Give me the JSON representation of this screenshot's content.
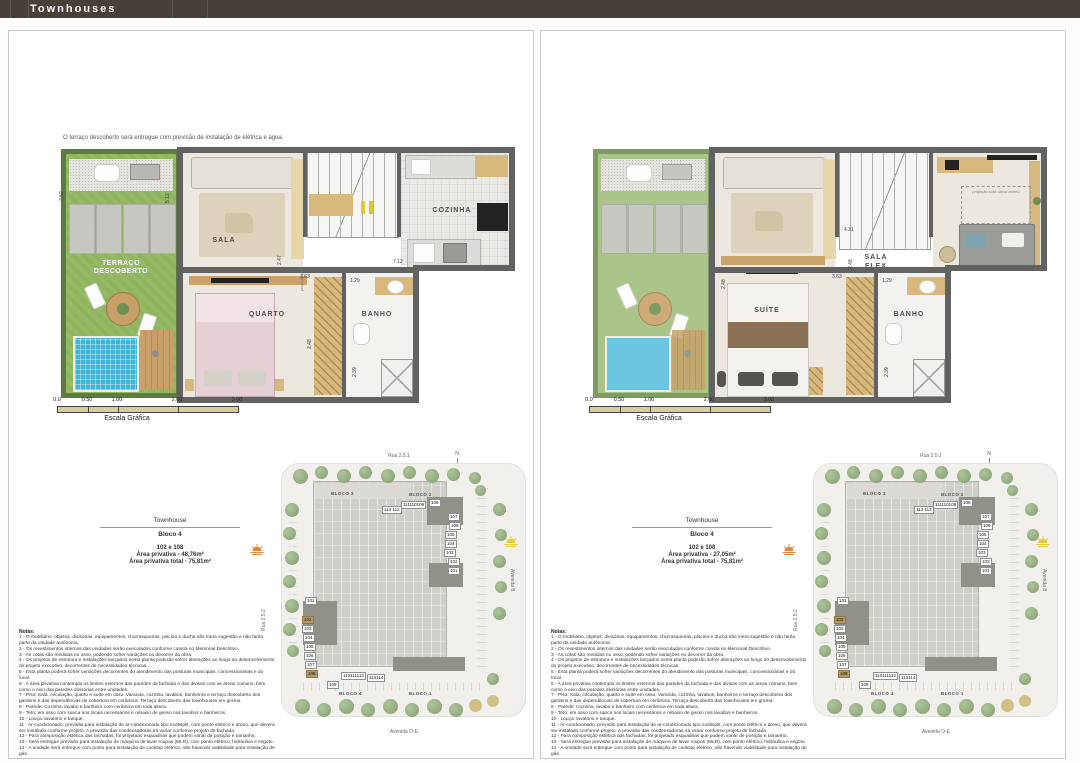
{
  "header": {
    "title": "Townhouses"
  },
  "colors": {
    "header_bg": "#474039",
    "wall": "#626262",
    "lawn": "#8fb55e",
    "lawn_faded": "#abc489",
    "hedge": "#5d7d40",
    "pool": "#41b5d8",
    "deck_wood": "#c9a06a",
    "floor": "#ece8df",
    "scalebar": "#d6cda2",
    "site_base": "#f1f0ec",
    "building": "#cfcfca",
    "building_dark": "#91918a",
    "unit_highlight": "#b29a62",
    "sun_orange": "#e0873a",
    "sun_yellow": "#e5c93f"
  },
  "scalebar": {
    "ticks": [
      {
        "t": "0.0",
        "x": 0
      },
      {
        "t": "0.50",
        "x": 30
      },
      {
        "t": "1.00",
        "x": 60
      },
      {
        "t": "2.00",
        "x": 120
      },
      {
        "t": "3.00",
        "x": 180
      }
    ],
    "label": "Escala Gráfica"
  },
  "panels": {
    "left": {
      "annotation": "O terraço descoberto será entregue com previsão de instalação de elétrica e água.",
      "plan": {
        "terrace1": "TERRAÇO",
        "terrace2": "DESCOBERTO",
        "rooms": {
          "sala": "SALA",
          "cozinha": "COZINHA",
          "quarto": "QUARTO",
          "banho": "BANHO"
        },
        "projection": "projeção pav.",
        "dims": [
          {
            "t": "2.52",
            "x": 50,
            "y": 170,
            "v": 1
          },
          {
            "t": "5.12",
            "x": 156,
            "y": 172,
            "v": 1
          },
          {
            "t": "2.47",
            "x": 268,
            "y": 234,
            "v": 1
          },
          {
            "t": "7.12",
            "x": 384,
            "y": 228
          },
          {
            "t": "3.63",
            "x": 291,
            "y": 243
          },
          {
            "t": "1.29",
            "x": 341,
            "y": 247
          },
          {
            "t": "2.48",
            "x": 298,
            "y": 318,
            "v": 1
          },
          {
            "t": "2.39",
            "x": 343,
            "y": 346,
            "v": 1
          }
        ]
      },
      "infobox": {
        "title": "Townhouse",
        "block": "Bloco 4",
        "units": "102 e 108",
        "area1": "Área privativa - 48,76m²",
        "area2": "Área privativa total - 75,81m²"
      }
    },
    "right": {
      "plan": {
        "terrace1": "TERRAÇO",
        "terrace2": "DESCOBERTO",
        "rooms": {
          "sala_flex1": "SALA",
          "sala_flex2": "FLEX",
          "suite": "SUÍTE",
          "banho": "BANHO"
        },
        "sofa_projection": "projeção sofá cama aberto",
        "dims": [
          {
            "t": "4.31",
            "x": 303,
            "y": 196
          },
          {
            "t": "2.48",
            "x": 307,
            "y": 238,
            "v": 1
          },
          {
            "t": "2.48",
            "x": 180,
            "y": 258,
            "v": 1
          },
          {
            "t": "3.63",
            "x": 291,
            "y": 243
          },
          {
            "t": "1.29",
            "x": 341,
            "y": 247
          },
          {
            "t": "2.39",
            "x": 343,
            "y": 346,
            "v": 1
          }
        ]
      },
      "infobox": {
        "title": "Townhouse",
        "block": "Bloco 4",
        "units": "102 e 108",
        "area1": "Área privativa - 27,05m²",
        "area2": "Área privativa total - 75,81m²"
      }
    }
  },
  "siteplan": {
    "streets": {
      "top": "Rua 2.5.1",
      "left": "Rua 2.5.2",
      "right": "Avenida 8",
      "bottom": "Avenida O-E"
    },
    "compass": "N",
    "blocks": {
      "b3": "BLOCO 3",
      "b2": "BLOCO 2",
      "b4": "BLOCO 4",
      "b1": "BLOCO 1"
    },
    "units": [
      {
        "t": "113 112",
        "x": 103,
        "y": 55
      },
      {
        "t": "111110109",
        "x": 122,
        "y": 50
      },
      {
        "t": "108",
        "x": 150,
        "y": 48
      },
      {
        "t": "107",
        "x": 169,
        "y": 62
      },
      {
        "t": "106",
        "x": 170,
        "y": 71
      },
      {
        "t": "105",
        "x": 166,
        "y": 80
      },
      {
        "t": "104",
        "x": 166,
        "y": 89
      },
      {
        "t": "103",
        "x": 165,
        "y": 98
      },
      {
        "t": "102",
        "x": 169,
        "y": 107
      },
      {
        "t": "101",
        "x": 169,
        "y": 116
      },
      {
        "t": "101",
        "x": 26,
        "y": 146
      },
      {
        "t": "102",
        "x": 23,
        "y": 165,
        "hl": 1
      },
      {
        "t": "103",
        "x": 23,
        "y": 174
      },
      {
        "t": "104",
        "x": 24,
        "y": 183
      },
      {
        "t": "105",
        "x": 25,
        "y": 192
      },
      {
        "t": "106",
        "x": 25,
        "y": 201
      },
      {
        "t": "107",
        "x": 26,
        "y": 210
      },
      {
        "t": "108",
        "x": 27,
        "y": 219,
        "hl": 1
      },
      {
        "t": "109",
        "x": 48,
        "y": 230
      },
      {
        "t": "110111112",
        "x": 62,
        "y": 221
      },
      {
        "t": "113114",
        "x": 88,
        "y": 223
      }
    ]
  },
  "notes": {
    "title": "Notas:",
    "items": [
      "1 - O mobiliário, objetos, divisórias, equipamentos, churrasqueiras, piscina e ducha são mera sugestão e não farão parte da unidade autônoma.",
      "2 - Os revestimentos internos das unidades serão executados conforme consta no Memorial Descritivo.",
      "3 - As cotas são medidas no osso, podendo sofrer variações no decorrer da obra.",
      "4 - Os projetos de estrutura e instalações lançados nesta planta poderão sofrer alterações ao longo do desenvolvimento do projeto executivo, decorrentes de necessidades técnicas.",
      "5 - Esta planta poderá sofrer variações decorrentes do atendimento das posturas municipais, concessionárias e do local.",
      "6 - A área privativa contempla os limites externos das paredes da fachada e das divisas com as áreas comuns, bem como o eixo das paredes divisórias entre unidades.",
      "7 - Piso: Sala, circulação, quarto e suíte em osso. Varanda, cozinha, lavabos, banheiros e terraço descoberto dos gardens e das dependências de cobertura em cerâmica. Terraço descoberto das townhouses em grama.",
      "8 - Parede: Cozinha, lavabo e banheiro com cerâmica em toda altura.",
      "9 - Teto: em osso com sanca nos locais necessários e rebaixo de gesso nos lavabos e banheiros.",
      "10 - Louça: lavatório e tanque.",
      "11 - Ar-condicionado: previsão para instalação de ar-condicionado tipo multisplit, com ponto elétrico e dreno, que deverá ser instalado conforme projeto. A previsão das condensadoras irá variar conforme projeto de fachada.",
      "12 - Para composição estética das fachadas, foi projetado esquadrias que podem variar de posição e tamanho.",
      "13 - Será entregue previsão para instalação de máquina de lavar roupas (MLR), com ponto elétrico, hidráulica e esgoto.",
      "14 - A unidade será entregue com ponto para instalação de cooktop elétrico, não havendo viabilidade para instalação de gás."
    ]
  }
}
